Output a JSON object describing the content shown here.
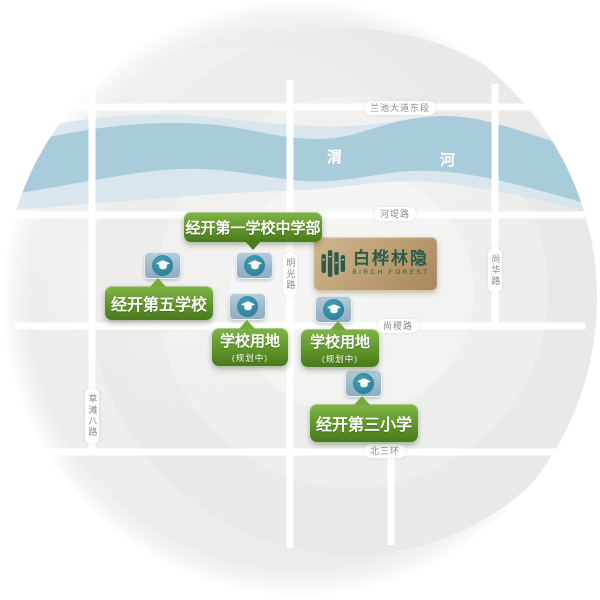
{
  "map": {
    "project": {
      "name": "白桦林隐",
      "name_en": "BIRCH FOREST"
    },
    "river": {
      "label_left": "渭",
      "label_right": "河"
    },
    "roads": {
      "lanchi": "兰池大道东段",
      "hedi": "河堤路",
      "mingguang": "明光路",
      "shanghua": "尚华路",
      "shangji": "尚稷路",
      "caotan": "草滩八路",
      "beisanhuan": "北三环"
    },
    "pois": [
      {
        "label": "经开第一学校中学部"
      },
      {
        "label": "经开第五学校"
      },
      {
        "label": "学校用地",
        "sub": "(规划中)"
      },
      {
        "label": "学校用地",
        "sub": "(规划中)"
      },
      {
        "label": "经开第三小学"
      }
    ],
    "colors": {
      "poi_green": "#5d9427",
      "marker_blue": "#9fbccd",
      "marker_teal": "#2f8aa4",
      "river_blue": "#a9ccdb",
      "project_gold": "#b7976a",
      "logo_green": "#2a5c49"
    }
  }
}
